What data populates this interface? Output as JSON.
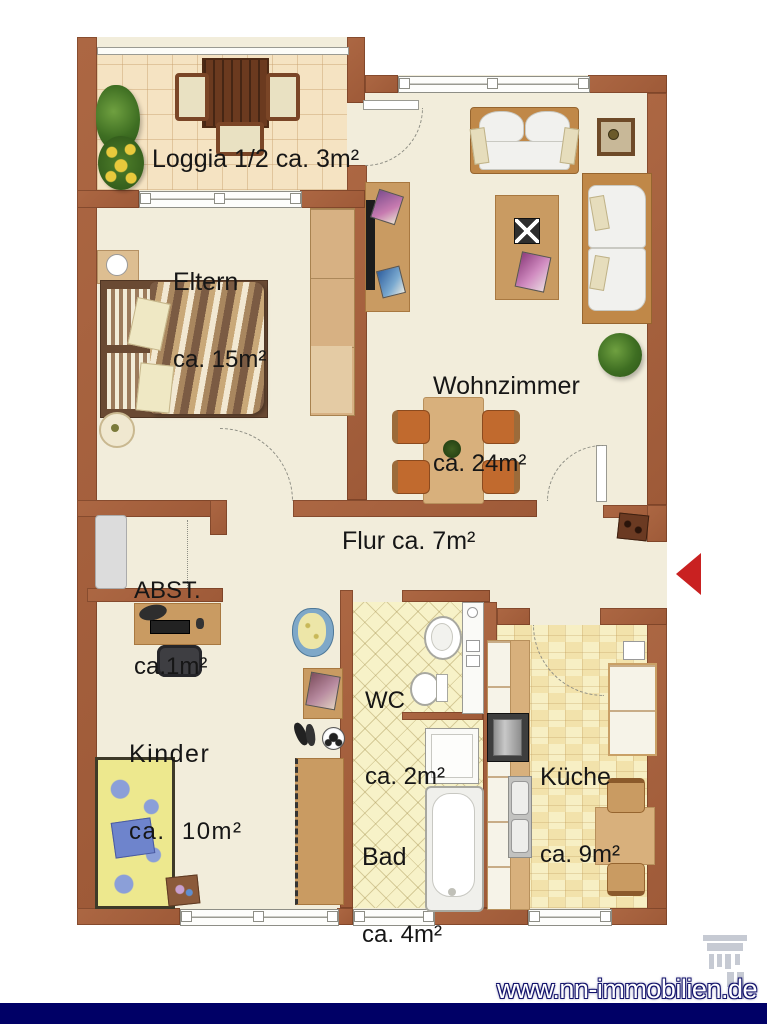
{
  "rooms": {
    "loggia": {
      "label": "Loggia 1/2 ca. 3m²"
    },
    "eltern": {
      "name": "Eltern",
      "size": "ca. 15m²"
    },
    "wohnzimmer": {
      "name": "Wohnzimmer",
      "size": "ca. 24m²"
    },
    "abstellraum": {
      "name": "ABST.",
      "size": "ca.1m²"
    },
    "flur": {
      "label": "Flur ca. 7m²"
    },
    "kinder": {
      "name": "Kinder",
      "size": "ca.  10m²"
    },
    "wc": {
      "name": "WC",
      "size": "ca. 2m²"
    },
    "bad": {
      "name": "Bad",
      "size": "ca. 4m²"
    },
    "kueche": {
      "name": "Küche",
      "size": "ca. 9m²"
    }
  },
  "footer": {
    "website": "www.nn-immobilien.de"
  },
  "colors": {
    "wall": "#A25E3B",
    "floor": "#F2EDDB",
    "navy_band": "#000066",
    "entrance_arrow": "#C92121"
  }
}
